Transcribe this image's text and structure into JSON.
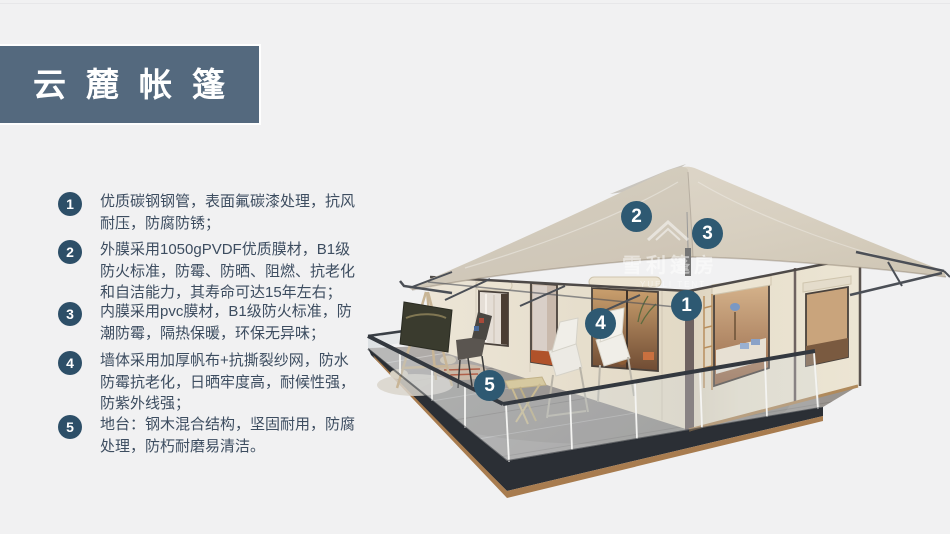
{
  "banner": {
    "title": "云麓帐篷"
  },
  "features": [
    {
      "num": "1",
      "text": "优质碳钢钢管，表面氟碳漆处理，抗风耐压，防腐防锈；"
    },
    {
      "num": "2",
      "text": "外膜采用1050gPVDF优质膜材，B1级防火标准，防霉、防晒、阻燃、抗老化和自洁能力，其寿命可达15年左右；"
    },
    {
      "num": "3",
      "text": "内膜采用pvc膜材，B1级防火标准，防潮防霉，隔热保暖，环保无异味；"
    },
    {
      "num": "4",
      "text": "墙体采用加厚帆布+抗撕裂纱网，防水防霉抗老化，日晒牢度高，耐候性强，防紫外线强；"
    },
    {
      "num": "5",
      "text": "地台：钢木混合结构，坚固耐用，防腐处理，防朽耐磨易清洁。"
    }
  ],
  "diagram": {
    "watermark": {
      "cn": "雪利篷房",
      "en": "YUELI TENT"
    },
    "callouts": [
      {
        "num": "1"
      },
      {
        "num": "2"
      },
      {
        "num": "3"
      },
      {
        "num": "4"
      },
      {
        "num": "5"
      }
    ]
  },
  "colors": {
    "background": "#f1f1f2",
    "banner": "#54697e",
    "accent": "#2e5972",
    "list_circle": "#2d4f68",
    "text": "#3d4d60",
    "roof": "#d9d1c2",
    "wall": "#eae2d2",
    "deck": "#a6a2a0",
    "rail": "#33383f",
    "wood": "#a87c4f"
  }
}
